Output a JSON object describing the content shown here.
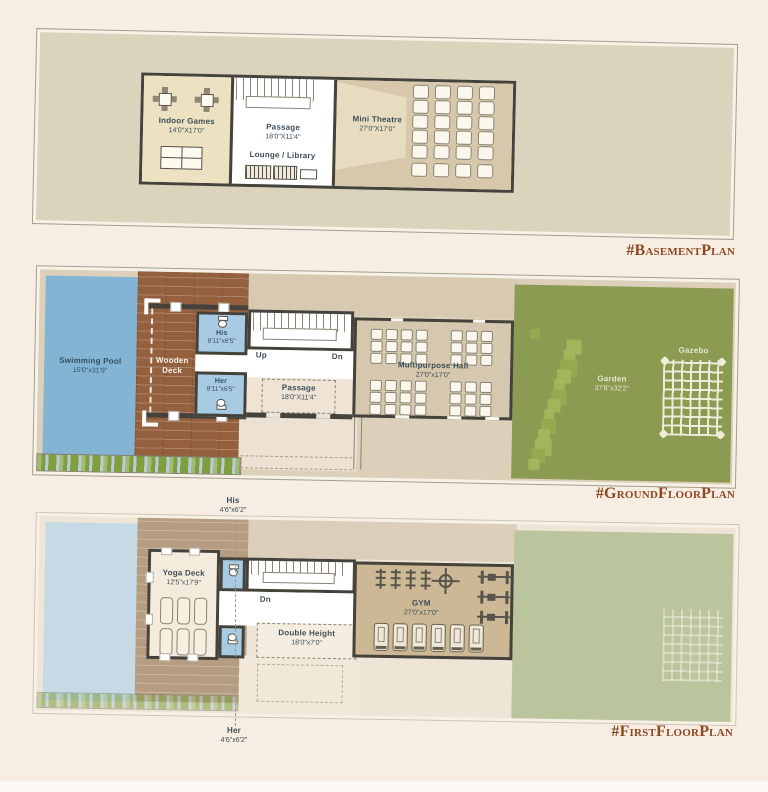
{
  "hashtags": {
    "basement": "#BasementPlan",
    "ground": "#GroundFloorPlan",
    "first": "#FirstFloorPlan"
  },
  "basement": {
    "indoor_games": {
      "name": "Indoor Games",
      "dims": "14'0\"X17'0\""
    },
    "passage": {
      "name": "Passage",
      "dims": "18'0\"X11'4\""
    },
    "lounge": {
      "name": "Lounge / Library"
    },
    "theatre": {
      "name": "Mini Theatre",
      "dims": "27'0\"X17'0\"",
      "seat_cols": 4,
      "seat_rows": 5,
      "seat_extra": 4
    }
  },
  "ground": {
    "pool": {
      "name": "Swimming Pool",
      "dims": "15'0\"x31'9\""
    },
    "deck": {
      "line1": "Wooden",
      "line2": "Deck"
    },
    "his": {
      "name": "His",
      "dims": "8'11\"x6'5\""
    },
    "her": {
      "name": "Her",
      "dims": "8'11\"x6'5\""
    },
    "up": "Up",
    "dn": "Dn",
    "passage": {
      "name": "Passage",
      "dims": "18'0\"X11'4\""
    },
    "hall": {
      "name": "Multipurpose Hall",
      "dims": "27'0\"x17'0\"",
      "chair_groups": [
        {
          "cols": 4,
          "rows": 3
        },
        {
          "cols": 3,
          "rows": 3
        },
        {
          "cols": 4,
          "rows": 3
        },
        {
          "cols": 3,
          "rows": 3
        }
      ]
    },
    "garden": {
      "name": "Garden",
      "dims": "37'8\"x32'2\""
    },
    "gazebo": {
      "name": "Gazebo"
    }
  },
  "first": {
    "his": {
      "name": "His",
      "dims": "4'6\"x6'2\""
    },
    "her": {
      "name": "Her",
      "dims": "4'6\"x6'2\""
    },
    "yoga": {
      "name": "Yoga Deck",
      "dims": "12'5\"x17'9\"",
      "mat_rows": 2,
      "mat_cols": 3
    },
    "dn": "Dn",
    "double_height": {
      "name": "Double Height",
      "dims": "18'0\"x7'0\""
    },
    "gym": {
      "name": "GYM",
      "dims": "27'0\"x17'0\"",
      "barbells": 4,
      "lat_machines": 3,
      "treadmills": 6
    }
  },
  "colors": {
    "background": "#f8ede3",
    "accent_hashtag": "#8c4a24",
    "wall": "#45423b",
    "pool": "#84b4d4",
    "pool_faded": "#c5dae4",
    "deck": "#94603e",
    "deck_faded": "#b69d81",
    "toilet_blue": "#a7cbe2",
    "garden": "#8b9b51",
    "garden_faded": "#bbc59d",
    "hall_fill": "#d6c8ae",
    "gym_fill": "#cdb895",
    "basement_fill": "#dcd3bc",
    "games_fill": "#ece2c2",
    "theatre_fill": "#d8c8ab",
    "label_text": "#3e4e59"
  }
}
